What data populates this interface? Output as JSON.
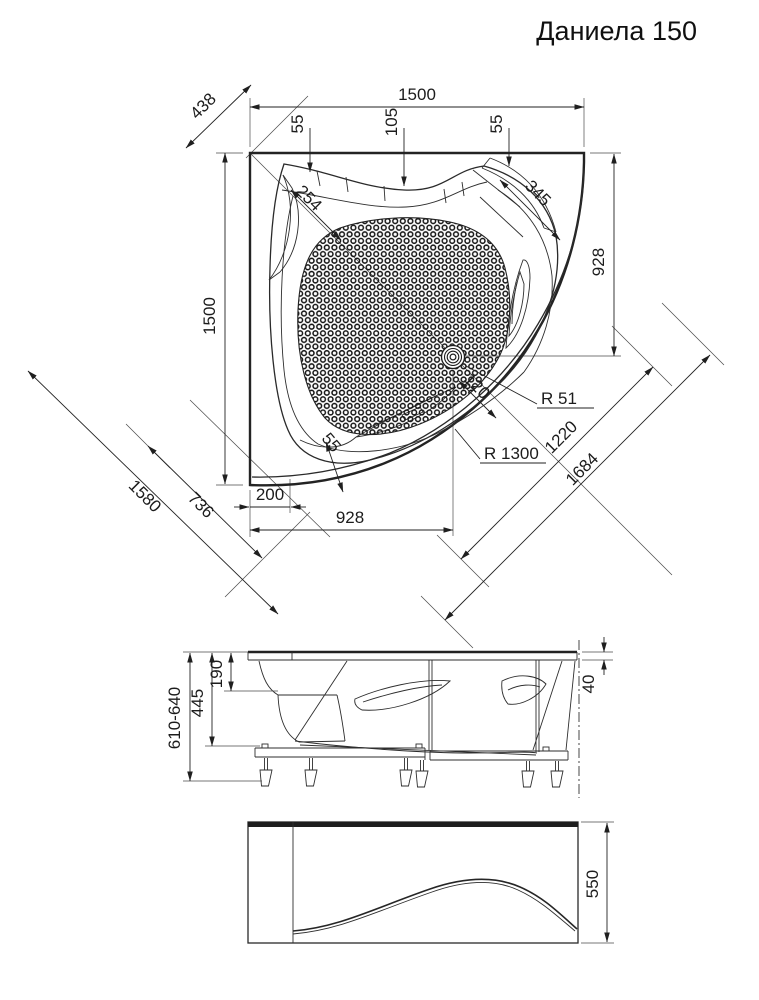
{
  "title": "Даниела 150",
  "top_view": {
    "width_total": "1500",
    "height_total": "1500",
    "corner_diag": "438",
    "rim_left": "55",
    "rim_center": "105",
    "rim_right": "55",
    "headrest_left": "254",
    "headrest_right": "345",
    "drain_from_top": "928",
    "drain_from_left": "928",
    "drain_offset_diag": "120",
    "drain_radius": "R 51",
    "front_radius": "R 1300",
    "diag_inner": "1220",
    "diag_outer": "1684",
    "diag_width": "1580",
    "diag_seat": "736",
    "rim_bottom": "55",
    "corner_offset": "200"
  },
  "side_view": {
    "height_adjustable": "610-640",
    "shell_height": "445",
    "rim_to_ledge": "190",
    "rim_height": "40"
  },
  "front_view": {
    "panel_height": "550"
  }
}
